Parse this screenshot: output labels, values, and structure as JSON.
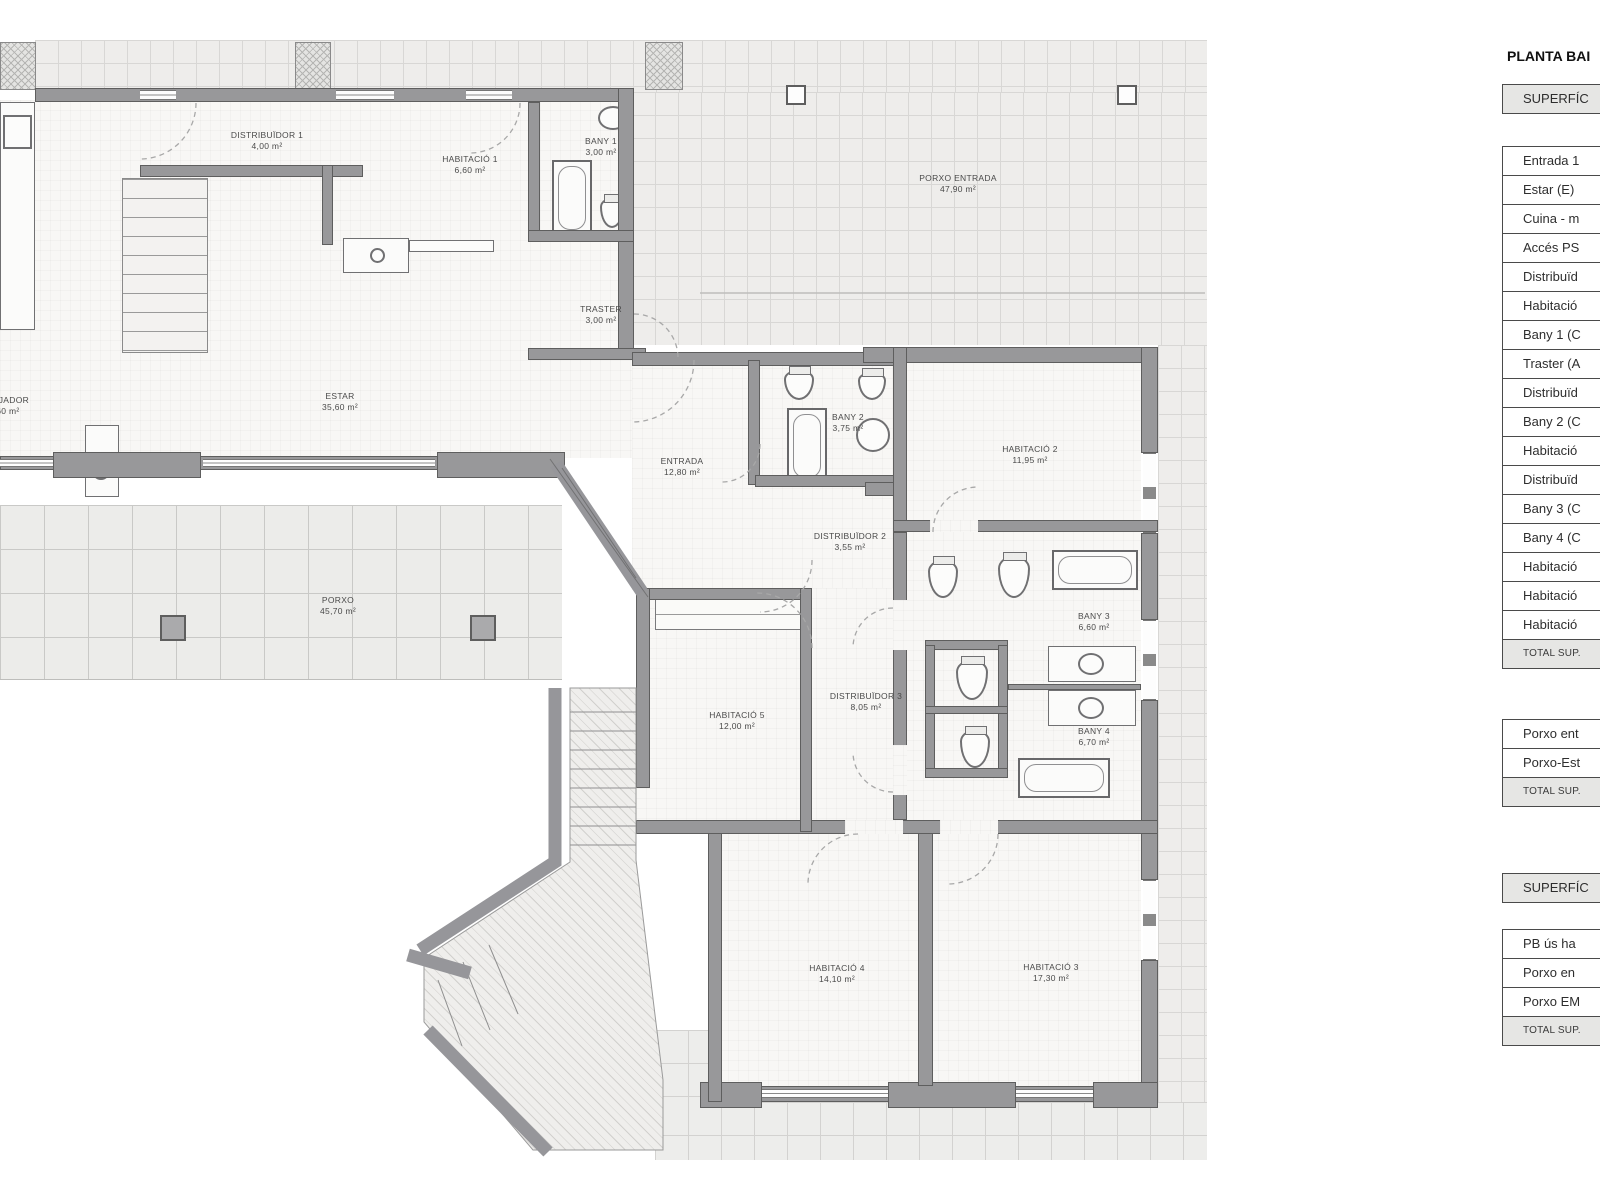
{
  "title": "PLANTA BAI",
  "sidebar": {
    "header1": "SUPERFÍC",
    "header2": "SUPERFÍC",
    "total_label": "TOTAL SUP.",
    "table1_rows": [
      "Entrada 1",
      "Estar (E)",
      "Cuina - m",
      "Accés PS",
      "Distribuïd",
      "Habitació",
      "Bany 1 (C",
      "Traster (A",
      "Distribuïd",
      "Bany 2 (C",
      "Habitació",
      "Distribuïd",
      "Bany 3 (C",
      "Bany 4 (C",
      "Habitació",
      "Habitació",
      "Habitació"
    ],
    "table2_rows": [
      "Porxo ent",
      "Porxo-Est"
    ],
    "table3_rows": [
      "PB ús ha",
      "Porxo en",
      "Porxo EM"
    ]
  },
  "plan": {
    "rooms": [
      {
        "name": "DISTRIBUÏDOR 1",
        "area": "4,00 m²"
      },
      {
        "name": "HABITACIÓ 1",
        "area": "6,60 m²"
      },
      {
        "name": "BANY 1",
        "area": "3,00 m²"
      },
      {
        "name": "TRASTER",
        "area": "3,00 m²"
      },
      {
        "name": "MENJADOR",
        "area": "2,60 m²"
      },
      {
        "name": "ESTAR",
        "area": "35,60 m²"
      },
      {
        "name": "ENTRADA",
        "area": "12,80 m²"
      },
      {
        "name": "BANY 2",
        "area": "3,75 m²"
      },
      {
        "name": "DISTRIBUÏDOR 2",
        "area": "3,55 m²"
      },
      {
        "name": "HABITACIÓ 2",
        "area": "11,95 m²"
      },
      {
        "name": "BANY 3",
        "area": "6,60 m²"
      },
      {
        "name": "BANY 4",
        "area": "6,70 m²"
      },
      {
        "name": "HABITACIÓ 5",
        "area": "12,00 m²"
      },
      {
        "name": "DISTRIBUÏDOR 3",
        "area": "8,05 m²"
      },
      {
        "name": "HABITACIÓ 4",
        "area": "14,10 m²"
      },
      {
        "name": "HABITACIÓ 3",
        "area": "17,30 m²"
      },
      {
        "name": "PORXO",
        "area": "45,70 m²"
      },
      {
        "name": "PORXO ENTRADA",
        "area": "47,90 m²"
      }
    ]
  },
  "colors": {
    "wall": "#98989a",
    "shaded": "#e6e6e4",
    "tile_line": "#d8d7d5"
  }
}
